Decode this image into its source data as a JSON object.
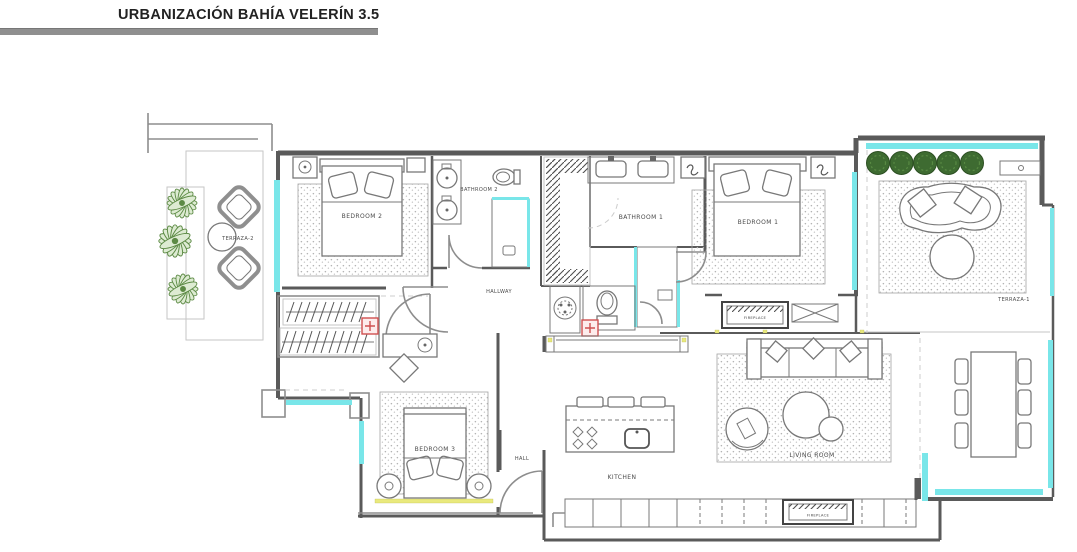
{
  "header": {
    "title": "URBANIZACIÓN BAHÍA VELERÍN 3.5"
  },
  "floor_plan": {
    "room_labels": {
      "terraza_2": "TERRAZA-2",
      "bedroom_2": "BEDROOM 2",
      "bathroom_2": "BATHROOM 2",
      "bathroom_1": "BATHROOM 1",
      "bedroom_1": "BEDROOM 1",
      "terraza_1": "TERRAZA-1",
      "hallway": "HALLWAY",
      "bedroom_3": "BEDROOM 3",
      "hall": "HALL",
      "kitchen": "KITCHEN",
      "living_room": "LIVING ROOM",
      "fireplace_interior": "FIREPLACE",
      "fireplace_kitchen": "FIREPLACE"
    },
    "colors": {
      "wall": "#5a5a5a",
      "window_glass": "#79e6e9",
      "plant_green": "#5c8a44",
      "bush_green": "#3e6b31",
      "marker_red": "#cf5050",
      "accent_yellow": "#e9e97d",
      "title_bar_gray": "#8f8f8f"
    }
  }
}
